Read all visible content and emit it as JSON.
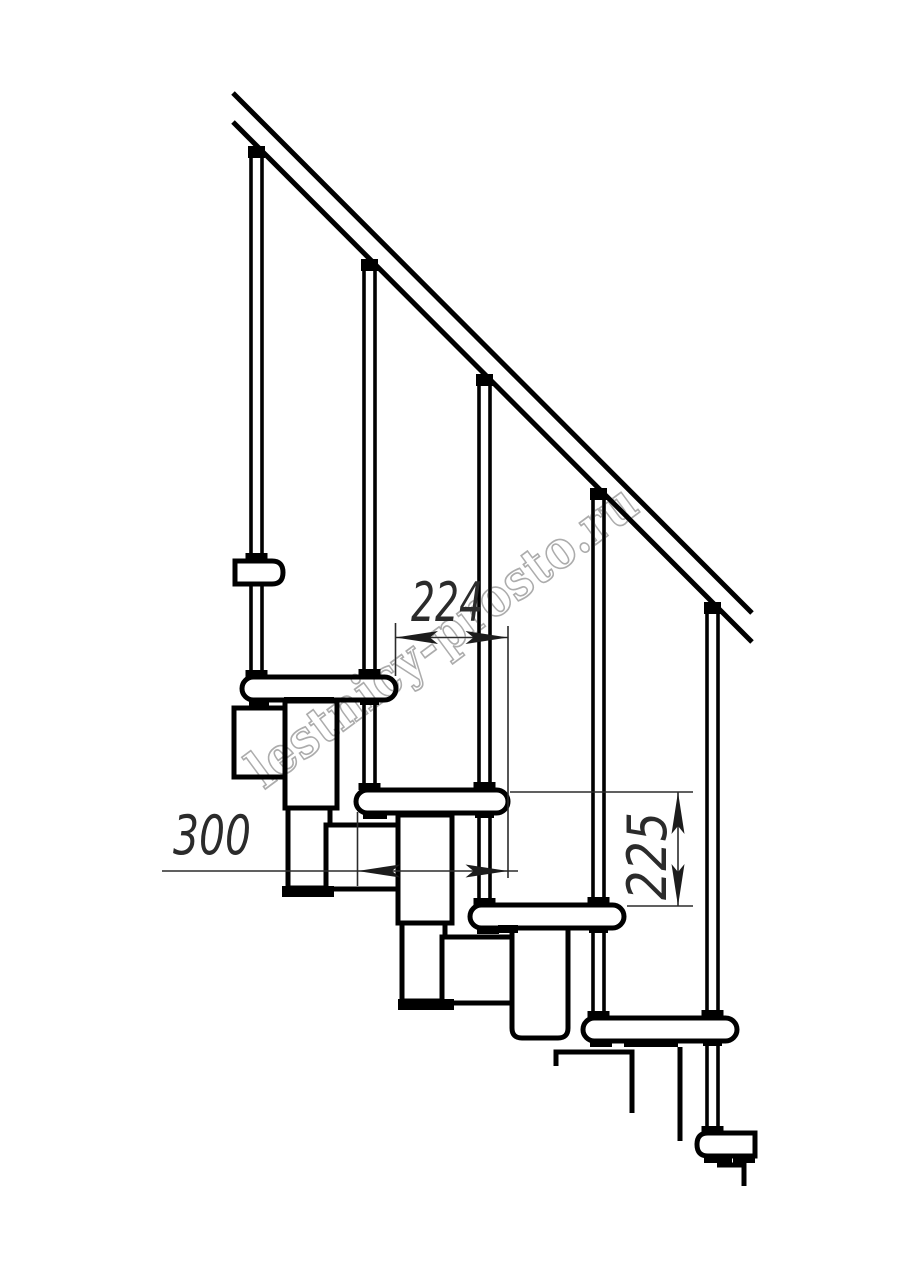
{
  "drawing": {
    "title": "modular staircase side elevation",
    "background": "#ffffff",
    "line_color": "#000000",
    "dim_color": "#2b2b2b",
    "watermark": {
      "text": "lestnicy-prosto.ru",
      "color": "#acacac"
    },
    "dimensions": {
      "step_run": {
        "label": "224"
      },
      "tread_length": {
        "label": "300"
      },
      "step_rise": {
        "label": "225"
      }
    },
    "counts": {
      "balusters": 5,
      "treads": 6,
      "handrail_lines": 2
    }
  }
}
